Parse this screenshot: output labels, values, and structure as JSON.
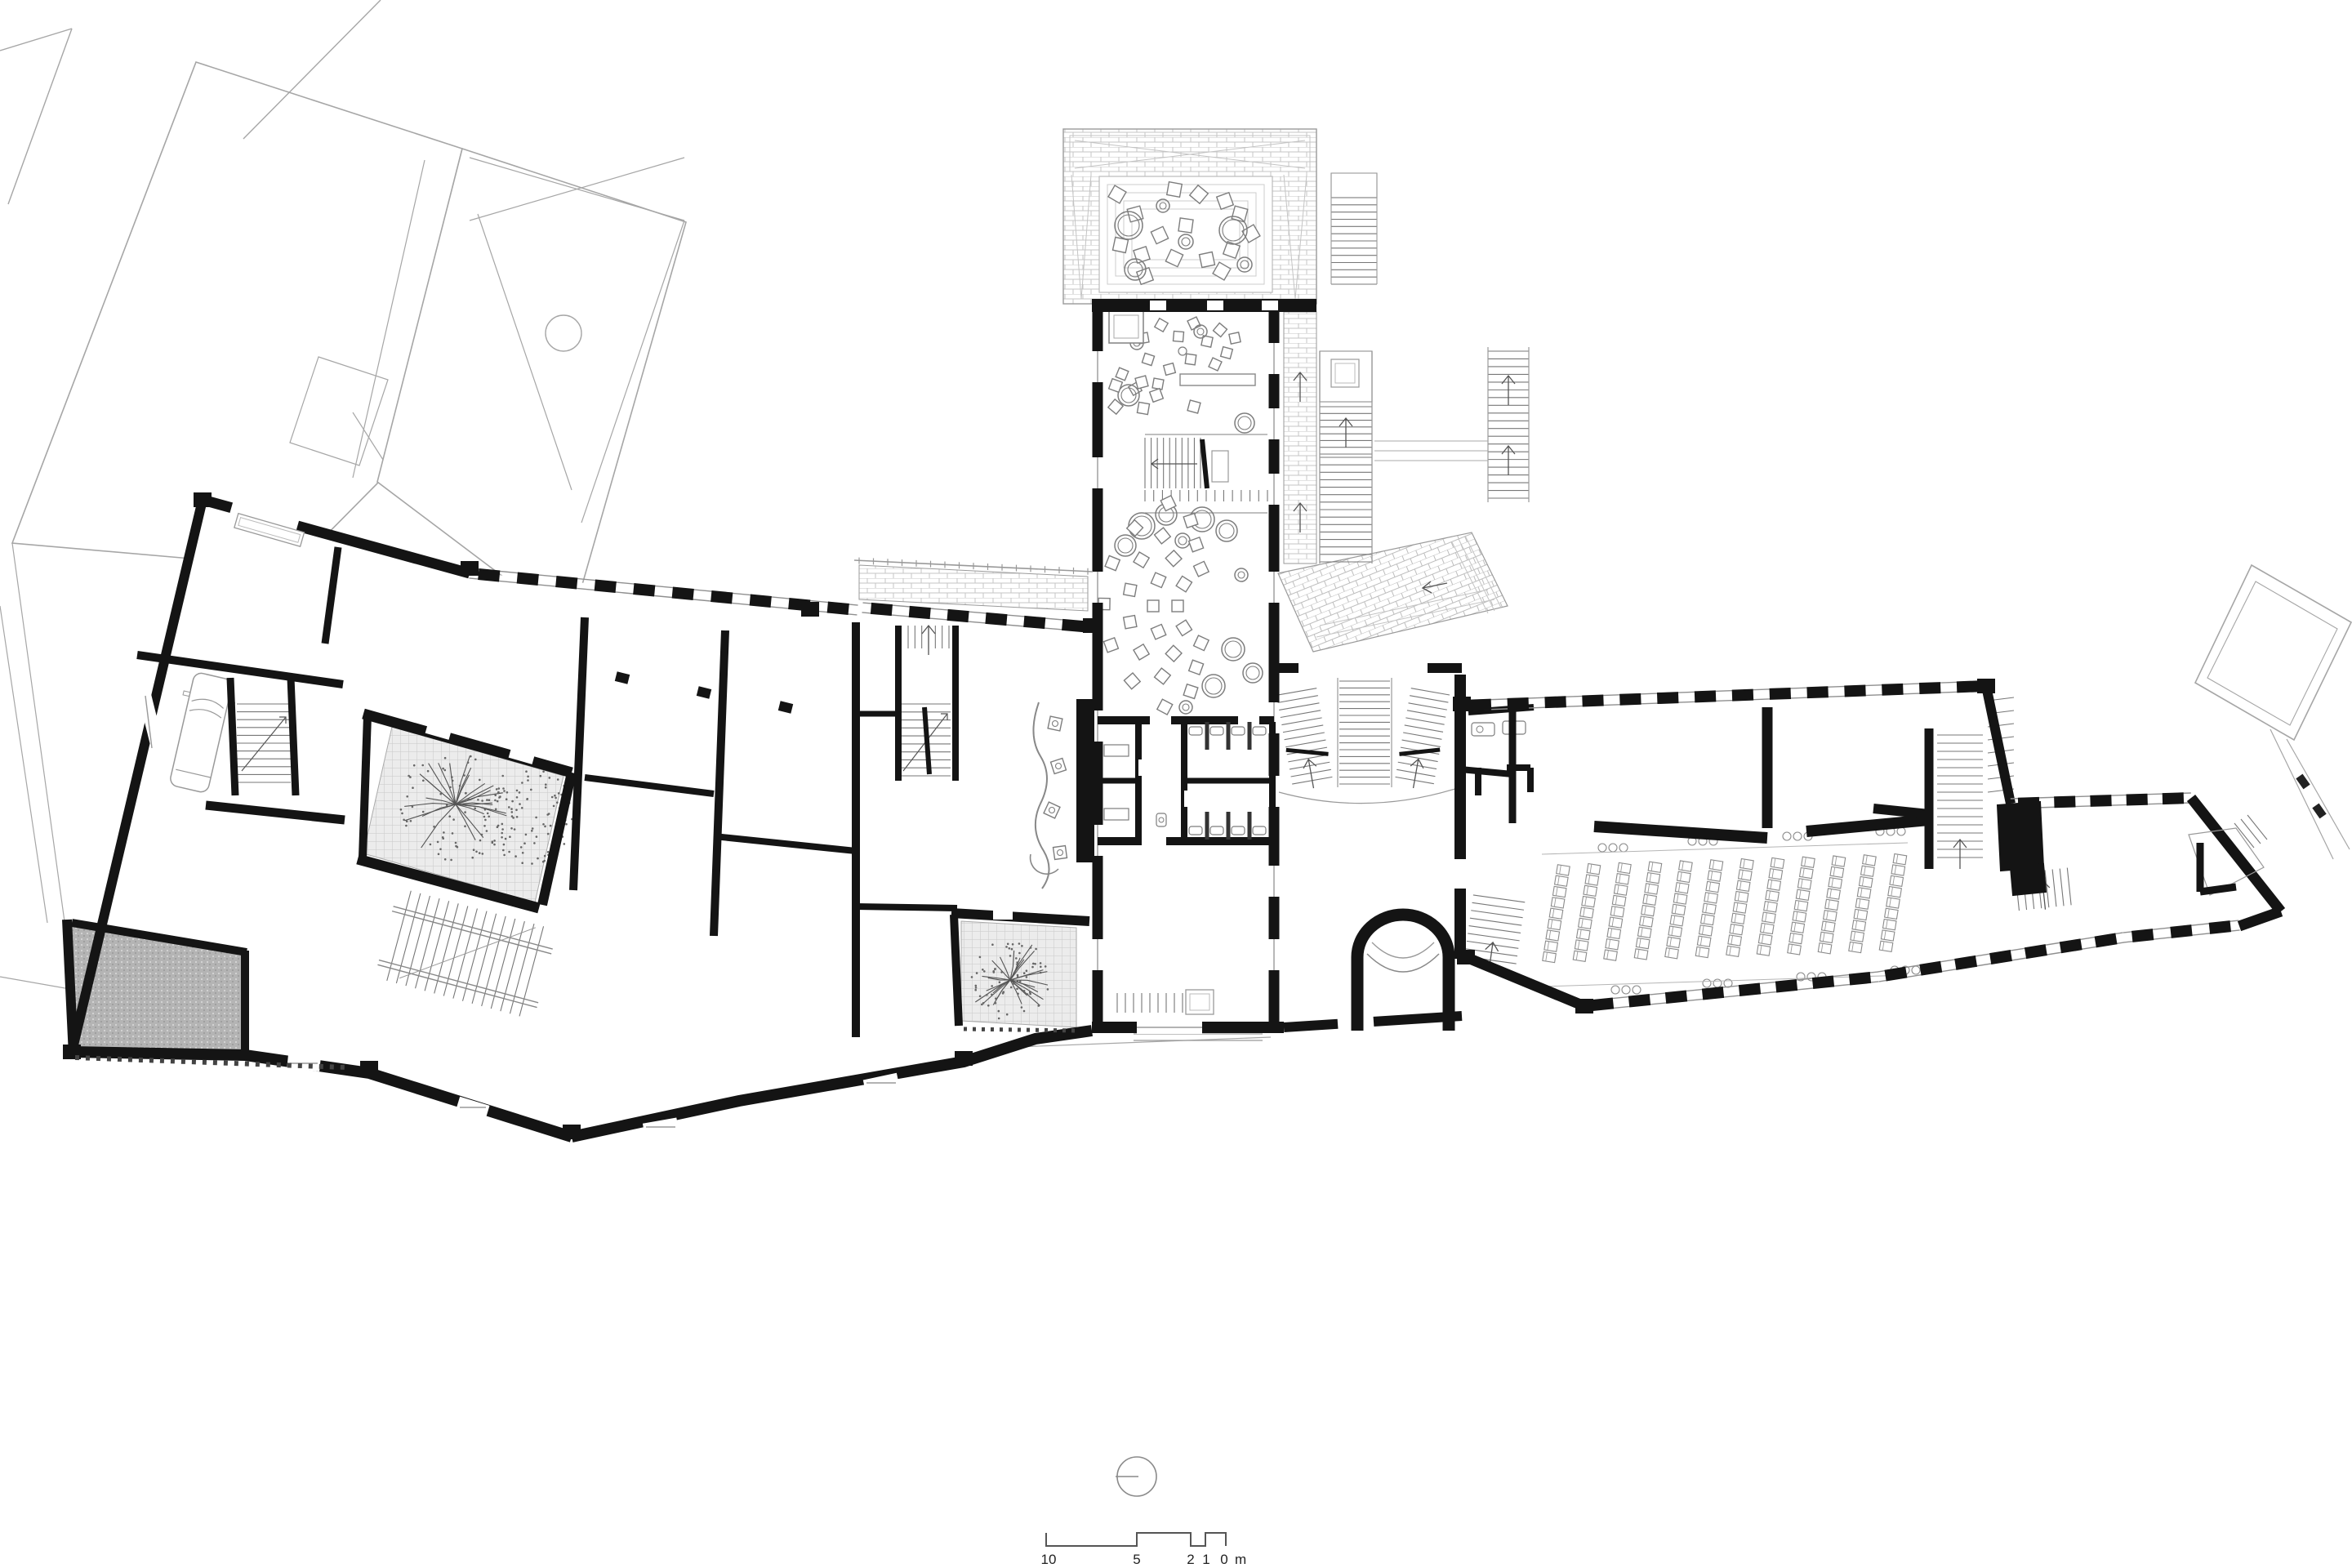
{
  "plan": {
    "colors": {
      "background": "#ffffff",
      "wall": "#141414",
      "context_line": "#a6a6a6",
      "paving_line": "#c4c4c4",
      "furniture_line": "#7d7d7d",
      "thin_line": "#8f8f8f",
      "gray_fill": "#b5b5b5"
    },
    "scale_bar": {
      "labels": [
        "10",
        "5",
        "2",
        "1",
        "0"
      ],
      "unit": "m"
    },
    "icons": {
      "north_arrow": "circle-with-west-bar",
      "tree": "branching-tree-symbol",
      "car": "parked-van-outline"
    }
  }
}
